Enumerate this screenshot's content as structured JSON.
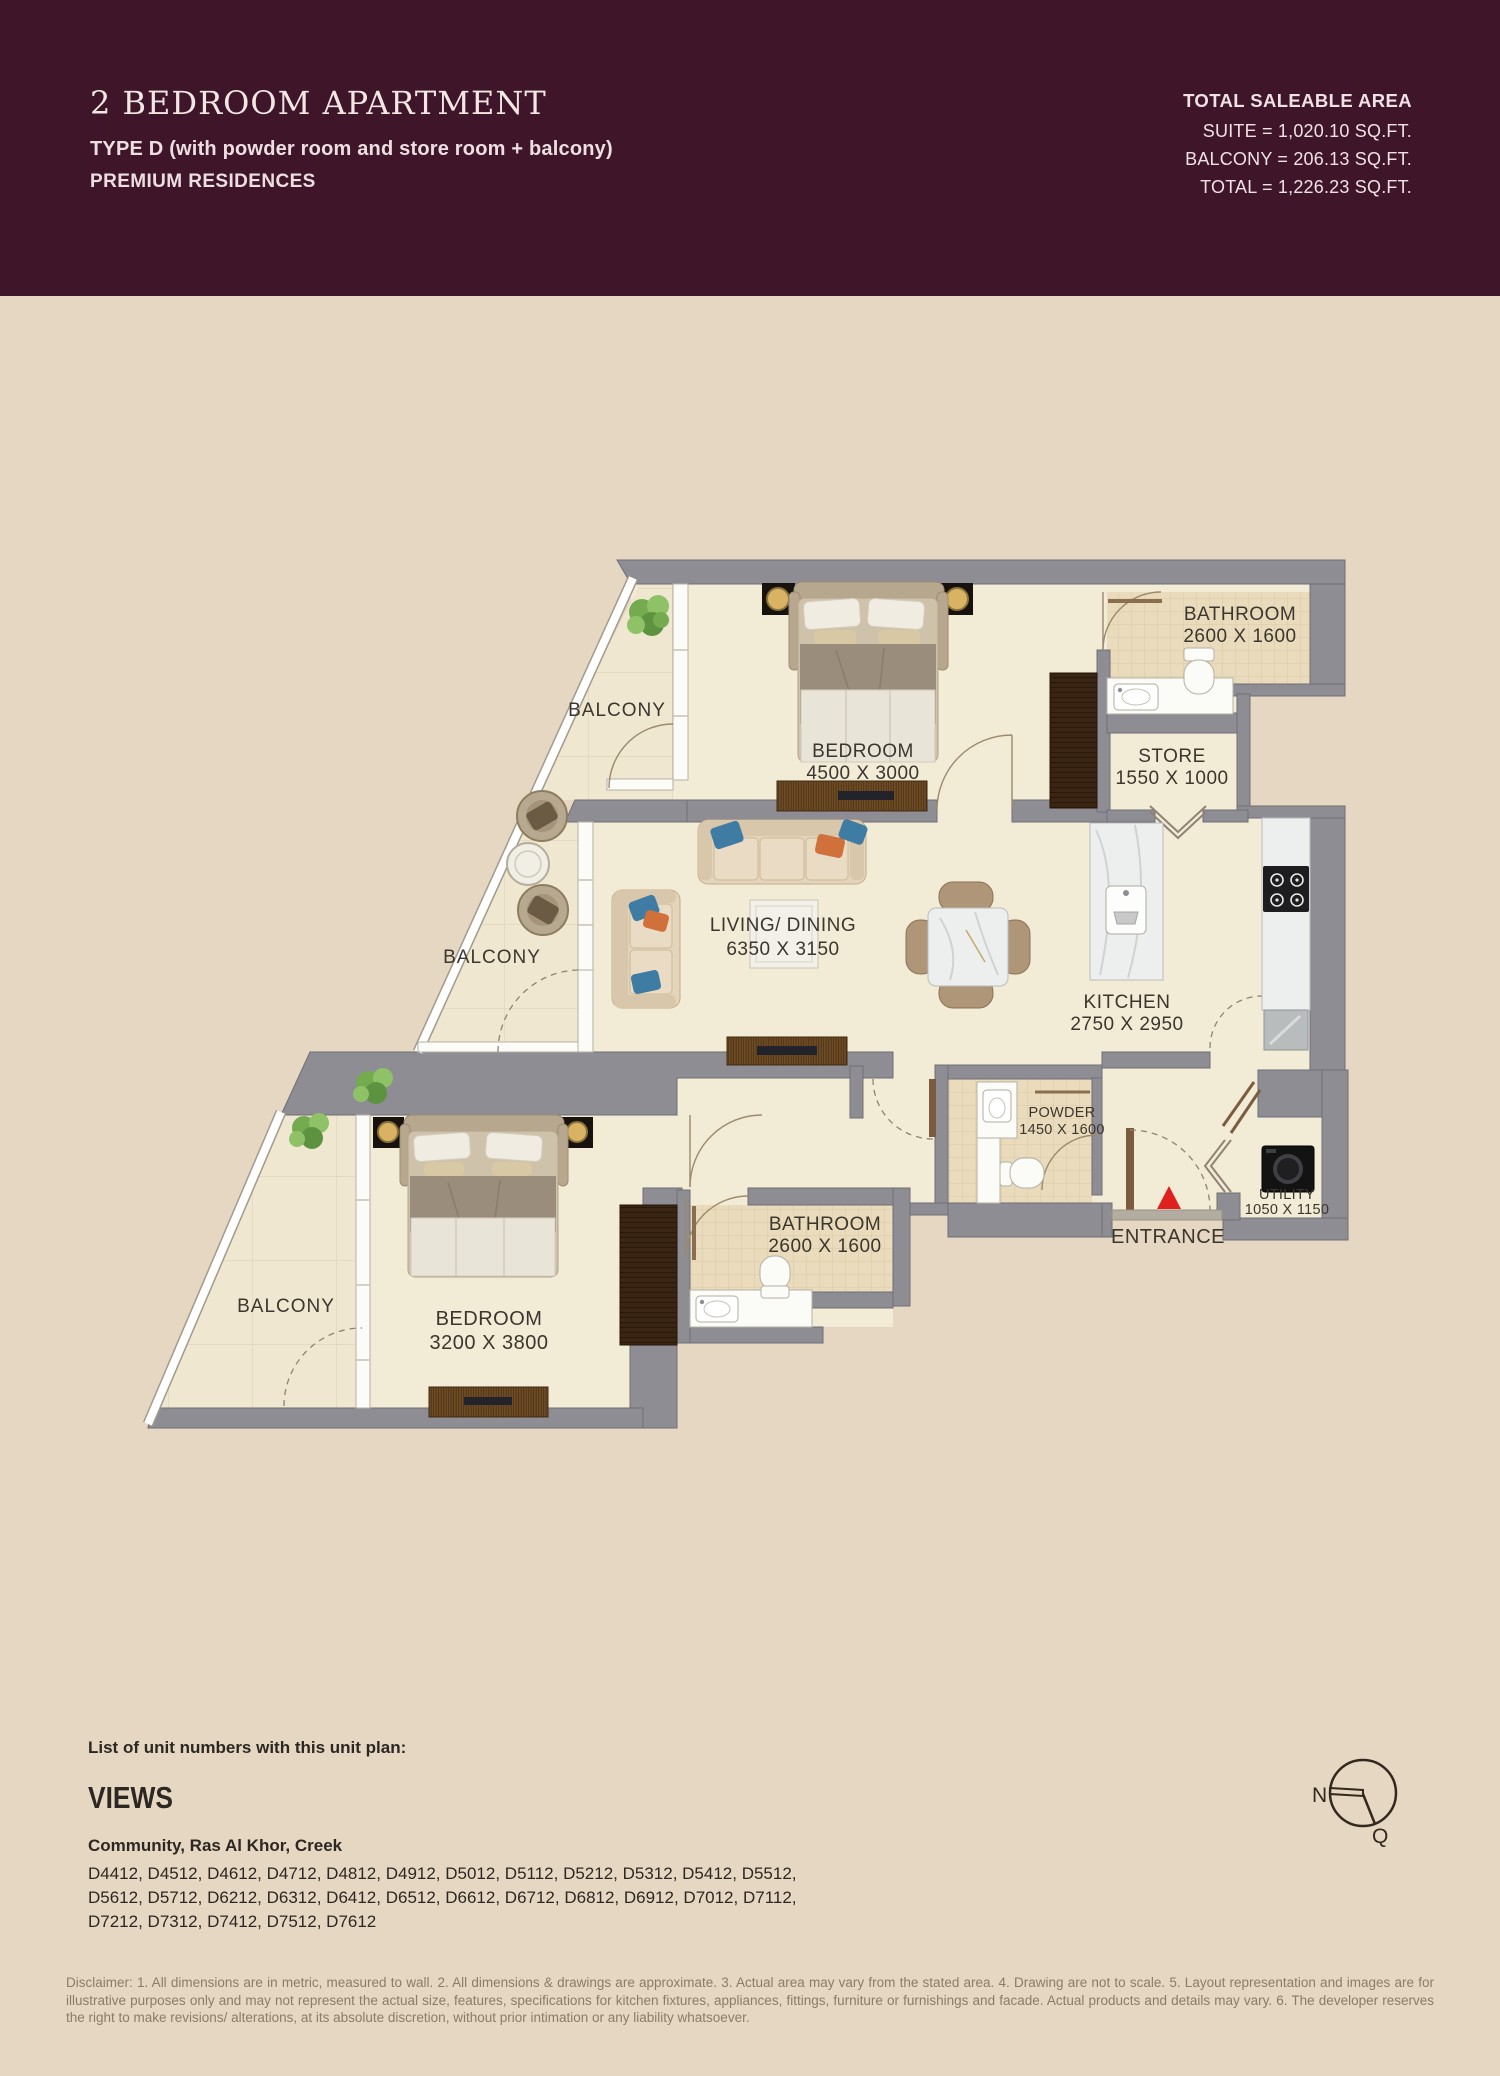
{
  "header": {
    "title": "2 BEDROOM APARTMENT",
    "type_line": "TYPE D (with powder room and store room + balcony)",
    "residences_line": "PREMIUM RESIDENCES",
    "bg_color": "#3e1529",
    "area": {
      "heading": "TOTAL SALEABLE AREA",
      "suite": "SUITE = 1,020.10 SQ.FT.",
      "balcony": "BALCONY = 206.13 SQ.FT.",
      "total": "TOTAL = 1,226.23 SQ.FT."
    }
  },
  "floor_plan": {
    "colors": {
      "wall": "#8d8d93",
      "interior_floor": "#f2ebd6",
      "balcony_floor": "#efe7d0",
      "tile_floor": "#e9dbbc",
      "entrance_marker": "#e01f1f"
    },
    "rooms": [
      {
        "name": "BEDROOM",
        "dims": "4500 X 3000"
      },
      {
        "name": "BATHROOM",
        "dims": "2600 X 1600"
      },
      {
        "name": "STORE",
        "dims": "1550 X 1000"
      },
      {
        "name": "LIVING/ DINING",
        "dims": "6350 X 3150"
      },
      {
        "name": "KITCHEN",
        "dims": "2750 X 2950"
      },
      {
        "name": "POWDER",
        "dims": "1450 X 1600"
      },
      {
        "name": "UTILITY",
        "dims": "1050 X 1150"
      },
      {
        "name": "BATHROOM",
        "dims": "2600 X 1600"
      },
      {
        "name": "BEDROOM",
        "dims": "3200 X 3800"
      }
    ],
    "balconies": [
      "BALCONY",
      "BALCONY",
      "BALCONY"
    ],
    "entrance_label": "ENTRANCE"
  },
  "footer": {
    "list_heading": "List of unit numbers with this unit plan:",
    "views_title": "VIEWS",
    "views_location": "Community, Ras Al Khor, Creek",
    "unit_lines": [
      "D4412, D4512, D4612, D4712, D4812, D4912, D5012, D5112, D5212, D5312, D5412, D5512,",
      "D5612, D5712, D6212, D6312, D6412, D6512, D6612, D6712, D6812, D6912, D7012, D7112,",
      "D7212, D7312, D7412, D7512, D7612"
    ],
    "compass": {
      "n": "N",
      "q": "Q"
    },
    "disclaimer": "Disclaimer: 1. All dimensions are in metric, measured to wall. 2. All dimensions & drawings are approximate. 3. Actual area may vary from the stated area. 4. Drawing are not to scale. 5. Layout representation and images are for illustrative purposes only and may not represent the actual size, features, specifications for kitchen fixtures, appliances, fittings, furniture or furnishings and facade. Actual products and details may vary. 6. The developer reserves the right to make revisions/ alterations, at its absolute discretion, without prior intimation or any liability whatsoever."
  }
}
